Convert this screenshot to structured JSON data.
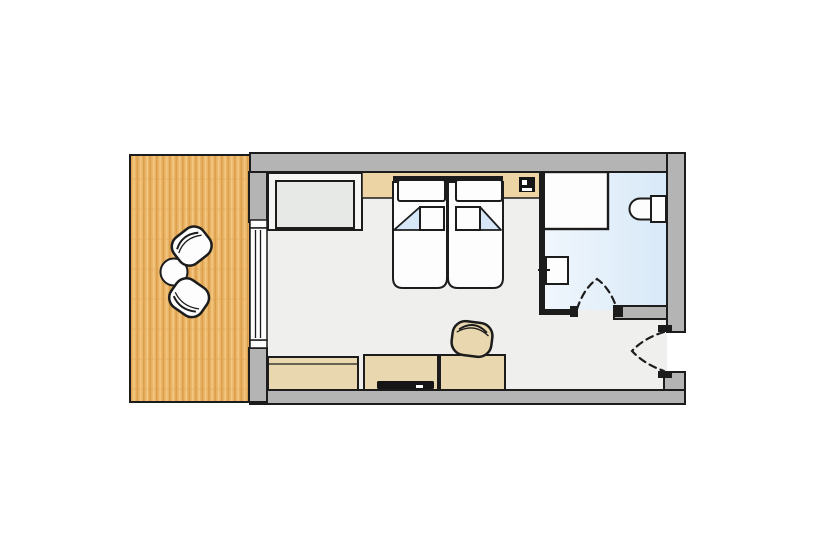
{
  "meta": {
    "kind": "hotel-room-floor-plan",
    "visible_text": []
  },
  "palette": {
    "background": "#ffffff",
    "outline": "#1c1c1c",
    "wall_fill": "#b4b4b4",
    "room_floor": "#efefed",
    "bathroom_floor_light": "#f0f6fc",
    "bathroom_floor_deep": "#d8e9f8",
    "balcony_wood": "#eab466",
    "balcony_wood_stripe": "#dc9f4e",
    "balcony_wood_light": "#f4c882",
    "furniture_beige": "#e9d8af",
    "headboard_tan": "#ecd4a4",
    "bed_white": "#fdfdfd",
    "fold_blue": "#d6e8f7",
    "sofa_outer": "#f5f5f3",
    "sofa_seat": "#e7e9e6",
    "dark_item": "#151515"
  },
  "scene": {
    "rooms": [
      {
        "name": "balcony-terrace",
        "floor": "wood-deck"
      },
      {
        "name": "bedroom",
        "floor": "light-gray"
      },
      {
        "name": "bathroom",
        "floor": "light-blue-tile"
      },
      {
        "name": "entry-vestibule",
        "floor": "light-gray"
      }
    ],
    "furniture_icons": [
      "terrace-round-table-icon",
      "terrace-chair-icon",
      "terrace-chair-icon",
      "sofa-bench-icon",
      "twin-bed-icon",
      "twin-bed-icon",
      "pillow-icon",
      "pillow-icon",
      "duvet-fold-icon",
      "wall-safe-icon",
      "shower-tray-icon",
      "toilet-icon",
      "sink-icon",
      "sideboard-icon",
      "tv-console-icon",
      "desk-icon",
      "desk-chair-icon",
      "window-icon",
      "door-swing-bathroom-icon",
      "door-swing-entry-icon"
    ]
  }
}
